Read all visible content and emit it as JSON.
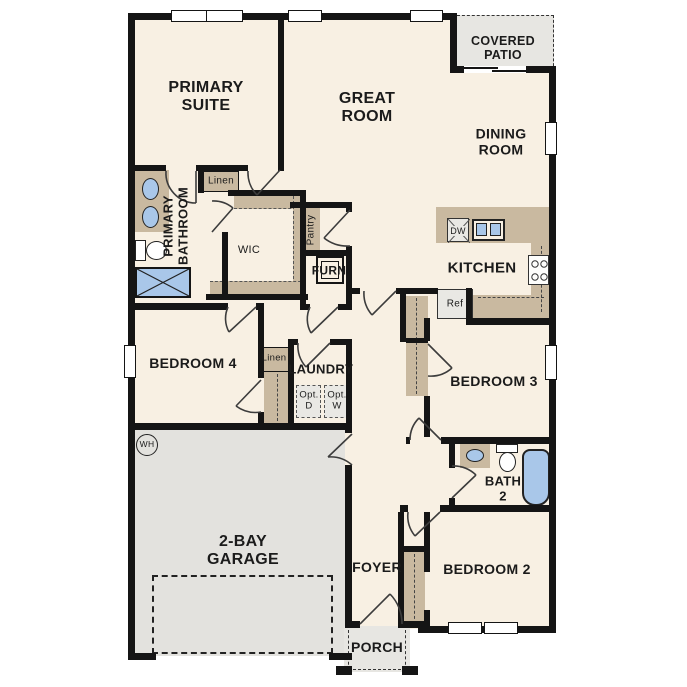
{
  "title": "Single-story floor plan",
  "colors": {
    "floor": "#f8f0e3",
    "gray_area": "#e3e2de",
    "patio_gray": "#e7e6e2",
    "tan": "#c9b9a0",
    "fixture_blue": "#a9c7e9",
    "wall": "#151515",
    "appliance_gray": "#e9e8e4"
  },
  "labels": {
    "primary_suite": "PRIMARY\nSUITE",
    "great_room": "GREAT\nROOM",
    "covered_patio": "COVERED\nPATIO",
    "dining_room": "DINING\nROOM",
    "primary_bathroom": "PRIMARY\nBATHROOM",
    "linen_primary": "Linen",
    "wic": "WIC",
    "pantry": "Pantry",
    "furnace": "FURN",
    "kitchen": "KITCHEN",
    "dishwasher": "DW",
    "refrigerator": "Ref",
    "bedroom4": "BEDROOM 4",
    "linen_hall": "Linen",
    "laundry": "LAUNDRY",
    "opt_dryer": "Opt.\nD",
    "opt_washer": "Opt.\nW",
    "bedroom3": "BEDROOM 3",
    "bath2": "BATH\n2",
    "bedroom2": "BEDROOM 2",
    "foyer": "FOYER",
    "garage": "2-BAY\nGARAGE",
    "porch": "PORCH",
    "water_heater": "WH"
  }
}
